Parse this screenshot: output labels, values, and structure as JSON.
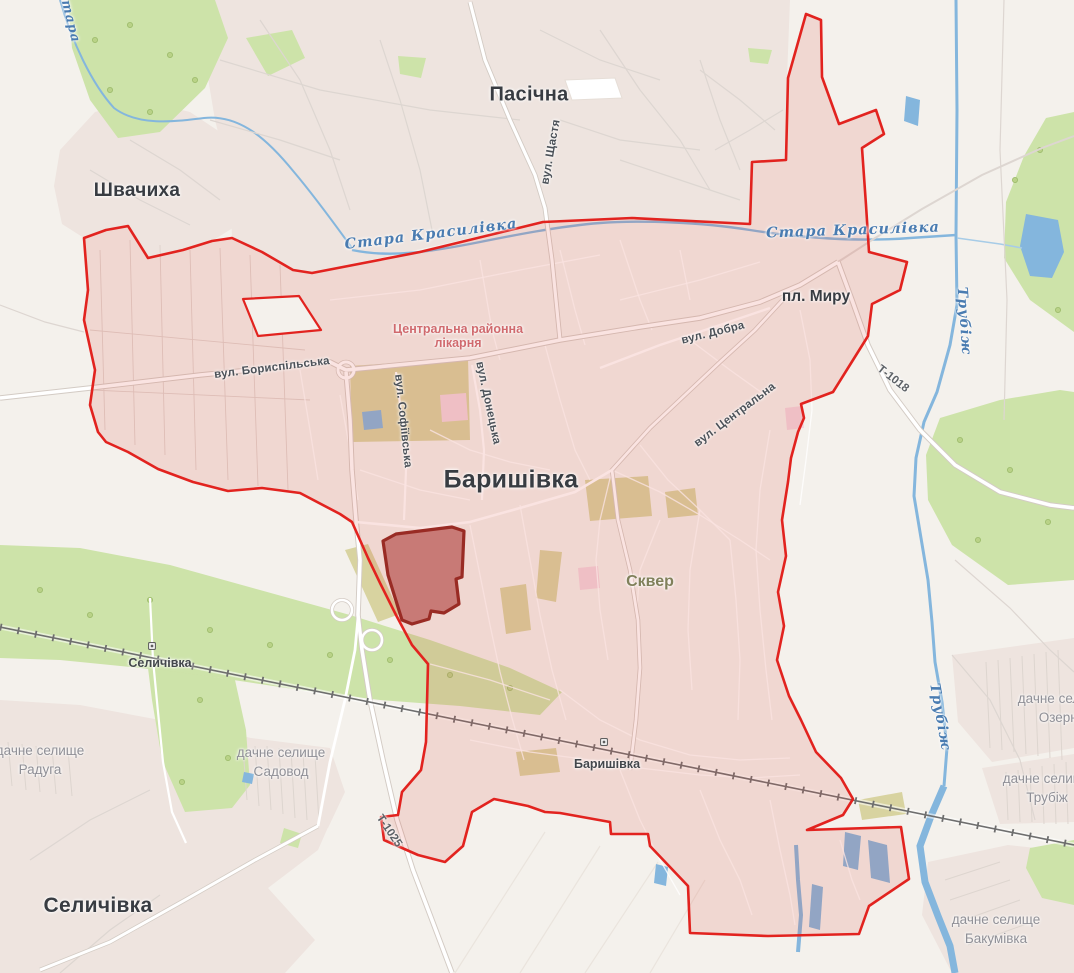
{
  "map_title": "Баришівка settlement boundary map",
  "labels": {
    "pasichna": "Пасічна",
    "shvachykha": "Швачиха",
    "baryshivka_town": "Баришівка",
    "selychivka_town": "Селичівка",
    "selychivka_station": "Селичівка",
    "baryshivka_station": "Баришівка",
    "pl_myru": "пл. Миру",
    "skver": "Сквер",
    "vul_shchastia": "вул. Щастя",
    "vul_boryspilska": "вул. Бориспільська",
    "vul_sofiivska": "вул. Софіївська",
    "vul_donetska": "вул. Донецька",
    "vul_dobra": "вул. Добра",
    "vul_tsentralna": "вул. Центральна",
    "hospital_line1": "Центральна районна",
    "hospital_line2": "лікарня",
    "stara_krasylivka_west": "Стара Красилівка",
    "stara_krasylivka_east": "Стара Красилівка",
    "stara_partial": "Стара",
    "trubizh_north": "Трубіж",
    "trubizh_south": "Трубіж",
    "road_t1018": "Т-1018",
    "road_t1025": "Т-1025",
    "dacha_line": "дачне селище",
    "raduga": "Радуга",
    "sadovod": "Садовод",
    "ozerne": "Озерне",
    "trubizh_dacha": "Трубіж",
    "bakumivka": "Бакумівка"
  },
  "colors": {
    "boundary_red": "#e2231f",
    "boundary_fill": "#e05347",
    "parcel_fill": "#c3706b",
    "parcel_stroke": "#992b24",
    "water": "#84b6dd",
    "forest": "#cde3a9",
    "park_khaki": "#d8d3a0",
    "urban": "#eee4df",
    "background": "#f4f1ec",
    "river_label": "#4a7cb1",
    "town_label": "#383c42"
  }
}
